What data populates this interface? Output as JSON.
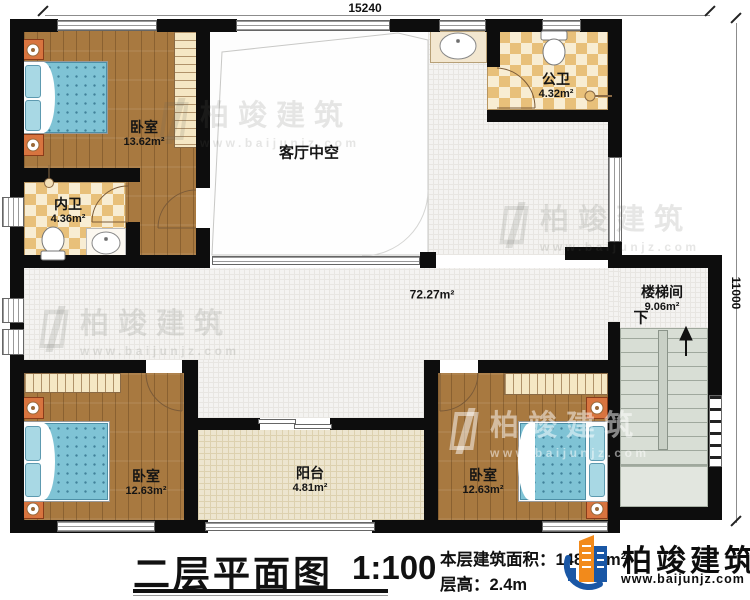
{
  "dimensions": {
    "top": "15240",
    "right": "11000"
  },
  "rooms": {
    "bedroom_top_left": {
      "name": "卧室",
      "area": "13.62m²"
    },
    "ensuite_bath": {
      "name": "内卫",
      "area": "4.36m²"
    },
    "public_bath": {
      "name": "公卫",
      "area": "4.32m²"
    },
    "living_void": {
      "name": "客厅中空"
    },
    "hallway": {
      "area": "72.27m²"
    },
    "stairwell": {
      "name": "楼梯间",
      "area": "9.06m²",
      "direction_label": "下"
    },
    "bedroom_bottom_left": {
      "name": "卧室",
      "area": "12.63m²"
    },
    "balcony": {
      "name": "阳台",
      "area": "4.81m²"
    },
    "bedroom_bottom_right": {
      "name": "卧室",
      "area": "12.63m²"
    }
  },
  "footer": {
    "title": "二层平面图",
    "scale": "1:100",
    "area_label": "本层建筑面积：",
    "area_value": "148.09m²",
    "floor_height_label": "层高：",
    "floor_height_value": "2.4m"
  },
  "branding": {
    "company": "柏竣建筑",
    "website": "www.baijunjz.com"
  },
  "watermark": {
    "company": "柏竣建筑",
    "website": "www.baijunjz.com"
  },
  "colors": {
    "wall": "#0d0d0d",
    "wood_floor": "#a87940",
    "bath_tile": "#e8c07a",
    "corridor_tile": "#f4f3f1",
    "balcony_tile": "#ede5cf",
    "mattress_blue": "#7fc3d5",
    "furniture_orange": "#d8743f",
    "stair_tread": "#d8ded5",
    "logo_blue": "#1a57a5",
    "logo_orange": "#f28a1b"
  }
}
